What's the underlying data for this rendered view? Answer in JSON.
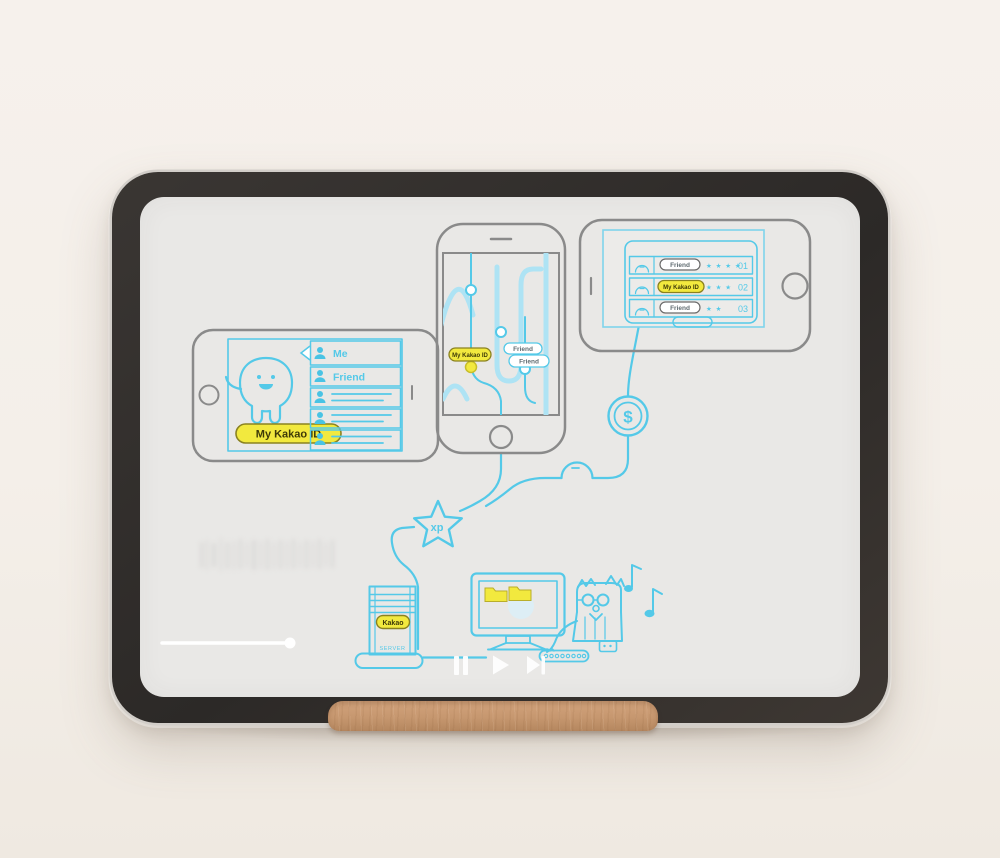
{
  "device": {
    "type": "tablet-on-wooden-stand",
    "bezel_color": "#2e2b28",
    "screen_color": "#e9e8e6",
    "stand_wood_color": "#c6976f"
  },
  "player": {
    "progress_percent": 19,
    "controls": [
      "pause-icon",
      "play-icon",
      "skip-next-icon"
    ]
  },
  "illustration": {
    "accent_cyan": "#54c9e8",
    "badge_yellow": "#f2e93e",
    "outline_gray": "#8a8a8a",
    "left_phone": {
      "badge": "My Kakao ID",
      "contacts": [
        {
          "label": "Me"
        },
        {
          "label": "Friend"
        },
        {
          "label": ""
        },
        {
          "label": ""
        },
        {
          "label": ""
        }
      ]
    },
    "middle_phone": {
      "badge": "My Kakao ID",
      "friends": [
        "Friend",
        "Friend"
      ]
    },
    "right_tablet": {
      "rows": [
        {
          "name": "Friend",
          "stars": "★ ★ ★ ★",
          "rank": "01"
        },
        {
          "name": "My Kakao ID",
          "stars": "★ ★ ★",
          "rank": "02"
        },
        {
          "name": "Friend",
          "stars": "★ ★",
          "rank": "03"
        }
      ]
    },
    "coin": {
      "symbol": "$"
    },
    "xp_star": {
      "label": "xp"
    },
    "server": {
      "badge": "Kakao",
      "label": "SERVER"
    }
  }
}
